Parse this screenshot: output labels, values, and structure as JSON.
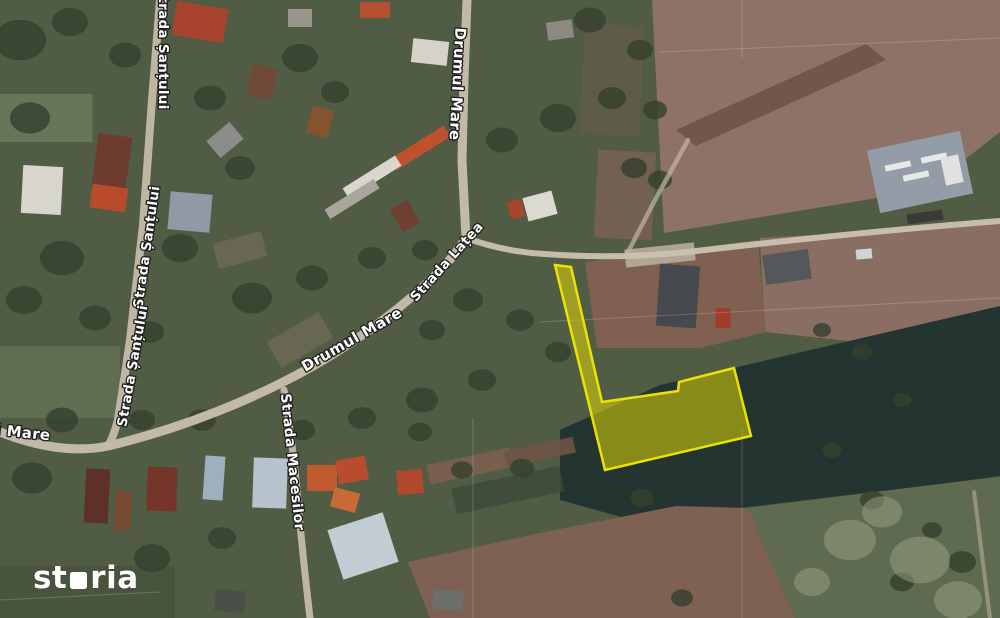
{
  "map": {
    "background_color": "#515c45",
    "label_style": {
      "fill": "#ffffff",
      "stroke": "#1c1c1c",
      "stroke_width": 2.6
    },
    "street_labels": [
      {
        "text": "Strada Șanțului",
        "x": 163,
        "y": 48,
        "rotation": 90,
        "size": 13.5
      },
      {
        "text": "Strada Șanțului",
        "x": 147,
        "y": 247,
        "rotation": -82,
        "size": 13.5
      },
      {
        "text": "Strada Șanțului",
        "x": 133,
        "y": 366,
        "rotation": -80,
        "size": 13.5
      },
      {
        "text": "Drumul Mare",
        "x": 457,
        "y": 84,
        "rotation": 93,
        "size": 15
      },
      {
        "text": "Drumul Mare",
        "x": 352,
        "y": 340,
        "rotation": -30,
        "size": 15
      },
      {
        "text": "Drumul Mare",
        "x": -6,
        "y": 430,
        "rotation": 6,
        "size": 15
      },
      {
        "text": "Strada Lațea",
        "x": 447,
        "y": 262,
        "rotation": -48,
        "size": 13.5
      },
      {
        "text": "Strada Macesilor",
        "x": 292,
        "y": 462,
        "rotation": 84,
        "size": 14
      }
    ],
    "property_polygon": {
      "points": "555,265 571,267 602,402 678,391 679,382 734,368 751,436 605,470",
      "fill": "#ebe100",
      "fill_opacity": 0.5,
      "stroke": "#ece300",
      "stroke_width": 2.5
    },
    "fields": [
      {
        "points": "652,0 1000,0 1000,132 926,190 664,233",
        "fill": "#8e7268",
        "opacity": 1
      },
      {
        "points": "676,130 866,44 886,60 696,146",
        "fill": "#6b5149",
        "opacity": 0.85
      },
      {
        "points": "760,238 1000,224 1000,332 905,347 765,332",
        "fill": "#8a6e63",
        "opacity": 1
      },
      {
        "points": "585,262 758,240 766,332 700,348 597,348",
        "fill": "#7f6051",
        "opacity": 1
      },
      {
        "points": "560,430 660,385 1000,306 1000,476 940,484 748,507 650,525 560,500",
        "fill": "#243430",
        "opacity": 1
      },
      {
        "points": "408,562 540,533 676,506 748,508 795,618 430,618",
        "fill": "#7e6152",
        "opacity": 1
      },
      {
        "points": "748,508 940,484 1000,477 1000,618 795,618",
        "fill": "#5e6b50",
        "opacity": 1
      }
    ],
    "patches": [
      {
        "x": 45,
        "y": 118,
        "w": 95,
        "h": 48,
        "rot": 0,
        "fill": "#7e8f6d",
        "opacity": 0.5
      },
      {
        "x": 60,
        "y": 382,
        "w": 120,
        "h": 72,
        "rot": 0,
        "fill": "#6f7d5d",
        "opacity": 0.5
      },
      {
        "x": 85,
        "y": 592,
        "w": 180,
        "h": 52,
        "rot": 0,
        "fill": "#41503a",
        "opacity": 0.6
      },
      {
        "x": 625,
        "y": 195,
        "w": 58,
        "h": 88,
        "rot": 3,
        "fill": "#7b6353",
        "opacity": 0.8
      },
      {
        "x": 470,
        "y": 466,
        "w": 85,
        "h": 20,
        "rot": -12,
        "fill": "#7b5e4e",
        "opacity": 0.9
      },
      {
        "x": 540,
        "y": 452,
        "w": 70,
        "h": 16,
        "rot": -12,
        "fill": "#6f5444",
        "opacity": 0.9
      },
      {
        "x": 300,
        "y": 340,
        "w": 60,
        "h": 30,
        "rot": -30,
        "fill": "#8a7866",
        "opacity": 0.4
      },
      {
        "x": 240,
        "y": 250,
        "w": 50,
        "h": 26,
        "rot": -15,
        "fill": "#8a7866",
        "opacity": 0.4
      },
      {
        "x": 612,
        "y": 80,
        "w": 60,
        "h": 110,
        "rot": 3,
        "fill": "#6e5a48",
        "opacity": 0.45
      },
      {
        "x": 660,
        "y": 255,
        "w": 70,
        "h": 18,
        "rot": -6,
        "fill": "#b7ad9c",
        "opacity": 0.9
      },
      {
        "x": 508,
        "y": 490,
        "w": 110,
        "h": 26,
        "rot": -12,
        "fill": "#3c4a37",
        "opacity": 0.8
      }
    ],
    "tree_blobs": {
      "fill": "#35402d",
      "opacity": 0.8,
      "items": [
        [
          20,
          40,
          26
        ],
        [
          70,
          22,
          18
        ],
        [
          125,
          55,
          16
        ],
        [
          30,
          118,
          20
        ],
        [
          210,
          98,
          16
        ],
        [
          300,
          58,
          18
        ],
        [
          335,
          92,
          14
        ],
        [
          240,
          168,
          15
        ],
        [
          180,
          248,
          18
        ],
        [
          62,
          258,
          22
        ],
        [
          24,
          300,
          18
        ],
        [
          95,
          318,
          16
        ],
        [
          150,
          332,
          14
        ],
        [
          252,
          298,
          20
        ],
        [
          312,
          278,
          16
        ],
        [
          372,
          258,
          14
        ],
        [
          425,
          250,
          13
        ],
        [
          468,
          300,
          15
        ],
        [
          432,
          330,
          13
        ],
        [
          502,
          140,
          16
        ],
        [
          558,
          118,
          18
        ],
        [
          612,
          98,
          14
        ],
        [
          634,
          168,
          13
        ],
        [
          520,
          320,
          14
        ],
        [
          558,
          352,
          13
        ],
        [
          482,
          380,
          14
        ],
        [
          422,
          400,
          16
        ],
        [
          362,
          418,
          14
        ],
        [
          302,
          430,
          13
        ],
        [
          202,
          420,
          14
        ],
        [
          142,
          420,
          13
        ],
        [
          62,
          420,
          16
        ],
        [
          32,
          478,
          20
        ],
        [
          152,
          558,
          18
        ],
        [
          222,
          538,
          14
        ],
        [
          420,
          432,
          12
        ],
        [
          462,
          470,
          11
        ],
        [
          522,
          468,
          12
        ],
        [
          642,
          498,
          12
        ],
        [
          822,
          330,
          9
        ],
        [
          862,
          352,
          10
        ],
        [
          902,
          400,
          9
        ],
        [
          832,
          450,
          10
        ],
        [
          872,
          500,
          12
        ],
        [
          932,
          530,
          10
        ],
        [
          962,
          562,
          14
        ],
        [
          902,
          582,
          12
        ],
        [
          682,
          598,
          11
        ],
        [
          590,
          20,
          16
        ],
        [
          640,
          50,
          13
        ],
        [
          655,
          110,
          12
        ],
        [
          660,
          180,
          12
        ]
      ]
    },
    "scrub_blobs": {
      "fill": "#99a184",
      "opacity": 0.5,
      "items": [
        [
          850,
          540,
          26
        ],
        [
          920,
          560,
          30
        ],
        [
          882,
          512,
          20
        ],
        [
          958,
          600,
          24
        ],
        [
          812,
          582,
          18
        ]
      ]
    },
    "buildings": [
      [
        42,
        190,
        40,
        48,
        3,
        "#d8d5cc"
      ],
      [
        200,
        22,
        52,
        34,
        10,
        "#a8432f"
      ],
      [
        300,
        18,
        24,
        18,
        0,
        "#9b968c"
      ],
      [
        375,
        10,
        30,
        16,
        0,
        "#b4502f"
      ],
      [
        430,
        52,
        36,
        24,
        6,
        "#d5d2c8"
      ],
      [
        560,
        30,
        26,
        18,
        -8,
        "#8e8a80"
      ],
      [
        262,
        82,
        26,
        32,
        10,
        "#6f4a39"
      ],
      [
        225,
        140,
        30,
        22,
        -40,
        "#8a8d8a"
      ],
      [
        112,
        162,
        34,
        54,
        8,
        "#6e3b2f"
      ],
      [
        109,
        198,
        36,
        24,
        8,
        "#b84b2c"
      ],
      [
        190,
        212,
        42,
        38,
        5,
        "#8f9aa6"
      ],
      [
        320,
        122,
        22,
        28,
        15,
        "#84542f"
      ],
      [
        420,
        148,
        64,
        13,
        -32,
        "#c0512e"
      ],
      [
        372,
        177,
        62,
        12,
        -32,
        "#d9d6cf"
      ],
      [
        352,
        199,
        58,
        11,
        -32,
        "#a9a69e"
      ],
      [
        405,
        216,
        20,
        26,
        -30,
        "#6f3f33"
      ],
      [
        540,
        206,
        30,
        24,
        -15,
        "#dcd9d0"
      ],
      [
        516,
        209,
        14,
        18,
        -15,
        "#a8452f"
      ],
      [
        678,
        296,
        40,
        62,
        4,
        "#46494d"
      ],
      [
        787,
        267,
        46,
        30,
        -8,
        "#55585b"
      ],
      [
        723,
        318,
        15,
        20,
        0,
        "#a03d2a"
      ],
      [
        864,
        254,
        16,
        10,
        -5,
        "#cfd4d6"
      ],
      [
        214,
        478,
        20,
        44,
        4,
        "#9db0bf"
      ],
      [
        270,
        483,
        34,
        50,
        2,
        "#b7c3cc"
      ],
      [
        322,
        478,
        30,
        26,
        0,
        "#c05a2f"
      ],
      [
        97,
        496,
        24,
        54,
        3,
        "#5f3028"
      ],
      [
        123,
        511,
        16,
        38,
        3,
        "#7a4b33"
      ],
      [
        162,
        489,
        30,
        44,
        2,
        "#76352a"
      ],
      [
        352,
        470,
        30,
        24,
        -10,
        "#b84c2c"
      ],
      [
        345,
        500,
        26,
        20,
        15,
        "#c76a35"
      ],
      [
        410,
        482,
        26,
        24,
        -5,
        "#b0492c"
      ],
      [
        363,
        546,
        58,
        52,
        -18,
        "#c2ccd3"
      ],
      [
        230,
        601,
        30,
        22,
        5,
        "#4a4f48"
      ],
      [
        448,
        600,
        30,
        20,
        3,
        "#6b6f68"
      ],
      [
        920,
        172,
        95,
        64,
        -12,
        "#939da7"
      ],
      [
        898,
        166,
        26,
        6,
        -12,
        "#e8e9e6"
      ],
      [
        916,
        176,
        26,
        6,
        -12,
        "#e8e9e6"
      ],
      [
        934,
        158,
        26,
        6,
        -12,
        "#e8e9e6"
      ],
      [
        952,
        170,
        18,
        28,
        -12,
        "#dfe2df"
      ],
      [
        925,
        217,
        36,
        10,
        -8,
        "#3a3b35"
      ]
    ],
    "roads": [
      {
        "d": "M467,0 L464,80 L462,160 L466,238",
        "width": 9,
        "color": "#c8bfac",
        "opacity": 0.95
      },
      {
        "d": "M466,238 C445,272 392,318 330,356 C258,400 175,430 108,446 C70,454 30,444 0,432",
        "width": 9,
        "color": "#c8bfac",
        "opacity": 0.95
      },
      {
        "d": "M160,0 L152,100 L143,225 L130,340 L118,420 Q113,438 108,446",
        "width": 8,
        "color": "#c4bba8",
        "opacity": 0.95
      },
      {
        "d": "M284,390 Q292,440 296,480 Q302,550 310,618",
        "width": 7,
        "color": "#c4bba8",
        "opacity": 0.95
      },
      {
        "d": "M466,238 Q505,252 545,254 Q625,260 705,250 Q860,232 1000,221",
        "width": 6,
        "color": "#cbc2ae",
        "opacity": 0.95
      },
      {
        "d": "M688,140 L655,200 L628,252",
        "width": 4.5,
        "color": "#c0b6a2",
        "opacity": 0.7
      },
      {
        "d": "M974,492 L990,618",
        "width": 4,
        "color": "#b3a692",
        "opacity": 0.65
      }
    ],
    "survey_lines": [
      [
        540,
        322,
        1000,
        298
      ],
      [
        473,
        418,
        473,
        618
      ],
      [
        742,
        0,
        742,
        58
      ],
      [
        742,
        428,
        742,
        618
      ],
      [
        660,
        52,
        1000,
        38
      ],
      [
        0,
        600,
        160,
        592
      ]
    ]
  },
  "watermark": {
    "brand_prefix": "st",
    "brand_o": "o",
    "brand_suffix": "ria"
  }
}
